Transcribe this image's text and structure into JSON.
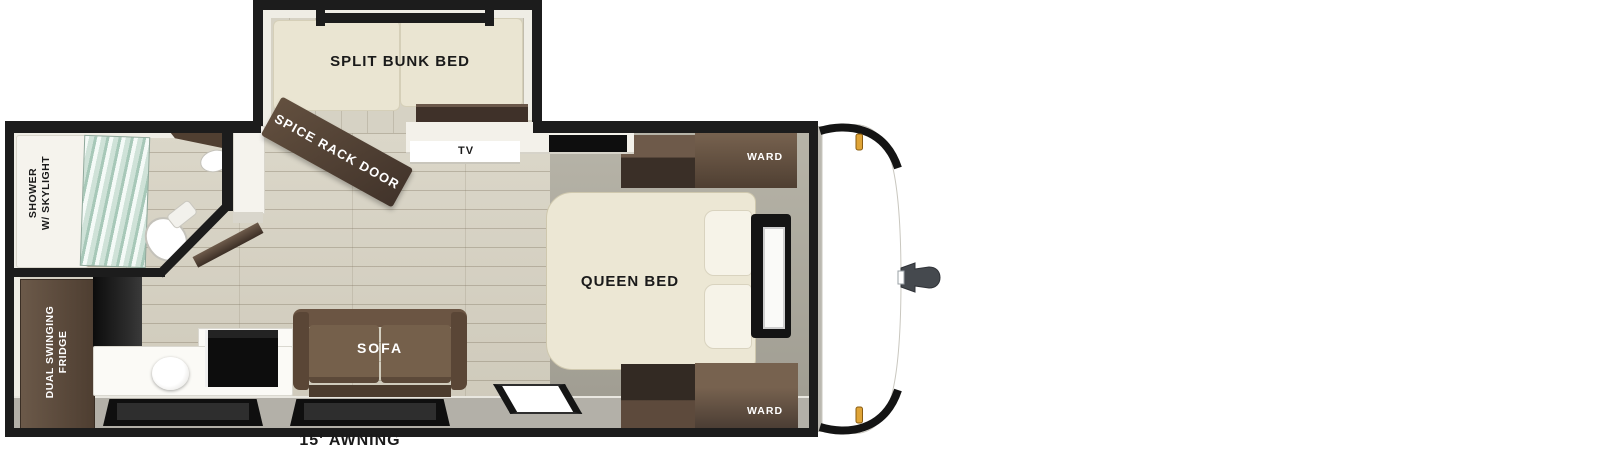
{
  "floorplan": {
    "bunk_room": {
      "bed": "SPLIT BUNK BED"
    },
    "bathroom": {
      "shower_line1": "SHOWER",
      "shower_line2": "W/ SKYLIGHT"
    },
    "kitchen": {
      "fridge_line1": "DUAL SWINGING",
      "fridge_line2": "FRIDGE"
    },
    "living": {
      "spice_door": "SPICE RACK DOOR",
      "tv": "TV",
      "sofa": "SOFA"
    },
    "bedroom": {
      "bed": "QUEEN BED",
      "wardrobe_front": "WARD",
      "wardrobe_rear": "WARD"
    },
    "exterior": {
      "awning": "15' AWNING"
    },
    "colors": {
      "wall": "#1c1c1c",
      "wood_floor": "#d6d2c4",
      "bedroom_floor": "#aba89c",
      "exterior_band": "#b3b0a8",
      "cabinet_brown": "#5d4a3c",
      "bed_cream": "#ece7d4",
      "marker_amber": "#dfa437"
    }
  }
}
